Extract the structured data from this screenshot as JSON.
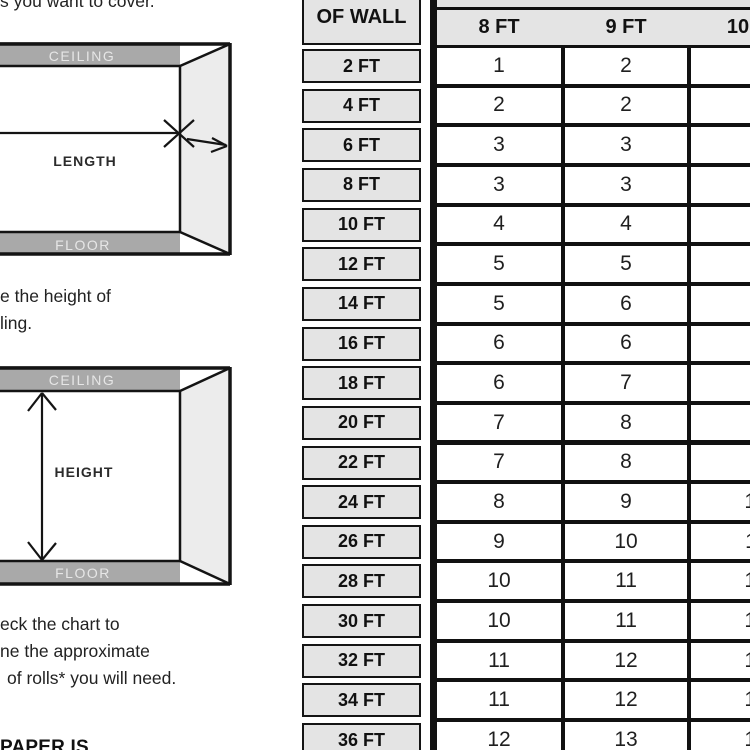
{
  "instructions": {
    "step1_fragment": "s you want to cover.",
    "step2_line1": "e the height of",
    "step2_line2": "ling.",
    "step3_line1": "eck the chart to",
    "step3_line2": "ne the approximate",
    "step3_line3": "of rolls* you will need.",
    "footer_fragment": "PAPER IS"
  },
  "diagram_length": {
    "ceiling": "CEILING",
    "floor": "FLOOR",
    "label": "LENGTH"
  },
  "diagram_height": {
    "ceiling": "CEILING",
    "floor": "FLOOR",
    "label": "HEIGHT"
  },
  "chart": {
    "row_header_title": "OF WALL",
    "col_headers": [
      "8 FT",
      "9 FT",
      "10 FT"
    ],
    "rows": [
      {
        "label": "2 FT",
        "values": [
          "1",
          "2",
          "2"
        ]
      },
      {
        "label": "4 FT",
        "values": [
          "2",
          "2",
          "3"
        ]
      },
      {
        "label": "6 FT",
        "values": [
          "3",
          "3",
          "3"
        ]
      },
      {
        "label": "8 FT",
        "values": [
          "3",
          "3",
          "4"
        ]
      },
      {
        "label": "10 FT",
        "values": [
          "4",
          "4",
          "5"
        ]
      },
      {
        "label": "12 FT",
        "values": [
          "5",
          "5",
          "6"
        ]
      },
      {
        "label": "14 FT",
        "values": [
          "5",
          "6",
          "6"
        ]
      },
      {
        "label": "16 FT",
        "values": [
          "6",
          "6",
          "7"
        ]
      },
      {
        "label": "18 FT",
        "values": [
          "6",
          "7",
          "8"
        ]
      },
      {
        "label": "20 FT",
        "values": [
          "7",
          "8",
          "9"
        ]
      },
      {
        "label": "22 FT",
        "values": [
          "7",
          "8",
          "9"
        ]
      },
      {
        "label": "24 FT",
        "values": [
          "8",
          "9",
          "10"
        ]
      },
      {
        "label": "26 FT",
        "values": [
          "9",
          "10",
          "11"
        ]
      },
      {
        "label": "28 FT",
        "values": [
          "10",
          "11",
          "12"
        ]
      },
      {
        "label": "30 FT",
        "values": [
          "10",
          "11",
          "12"
        ]
      },
      {
        "label": "32 FT",
        "values": [
          "11",
          "12",
          "13"
        ]
      },
      {
        "label": "34 FT",
        "values": [
          "11",
          "12",
          "14"
        ]
      },
      {
        "label": "36 FT",
        "values": [
          "12",
          "13",
          "14"
        ]
      }
    ]
  },
  "colors": {
    "bar_gray": "#a9a9a9",
    "side_wall": "#ececec",
    "cell_gray": "#e4e4e4",
    "line_black": "#141414",
    "bar_text": "#e6e6e6"
  }
}
